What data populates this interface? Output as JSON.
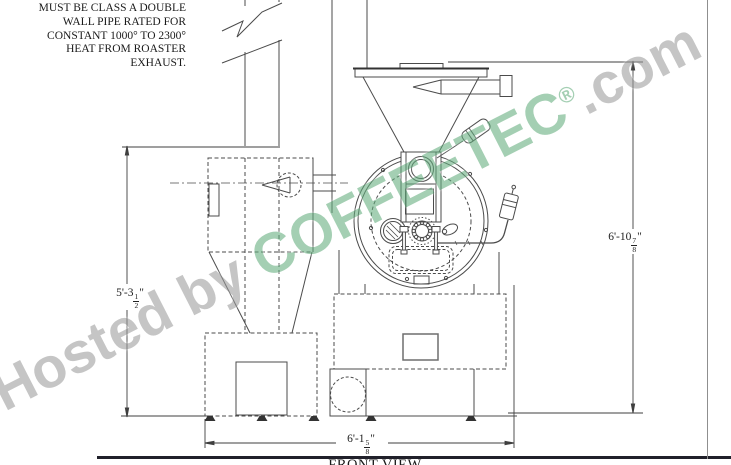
{
  "note": {
    "lines": [
      "MUST BE CLASS A DOUBLE",
      "WALL PIPE RATED FOR",
      "CONSTANT 1000° TO 2300°",
      "HEAT FROM ROASTER",
      "EXHAUST."
    ]
  },
  "dimensions": {
    "left": {
      "pre": "5'-3",
      "num": "1",
      "den": "2",
      "post": "\""
    },
    "right": {
      "pre": "6'-10",
      "num": "7",
      "den": "8",
      "post": "\""
    },
    "bottom": {
      "pre": "6'-1",
      "num": "5",
      "den": "8",
      "post": "\""
    }
  },
  "view_label": "FRONT VIEW",
  "watermark": {
    "prefix": "Hosted by ",
    "brand": "COFFEETEC",
    "reg": "®",
    "suffix": ".com"
  },
  "colors": {
    "drawing_line": "#4b4b4b",
    "watermark_green": "#63ad7d",
    "watermark_gray": "#9c9c9c",
    "sheet_border_bottom": "#20202a",
    "sheet_border_right": "#8f8f8f"
  }
}
